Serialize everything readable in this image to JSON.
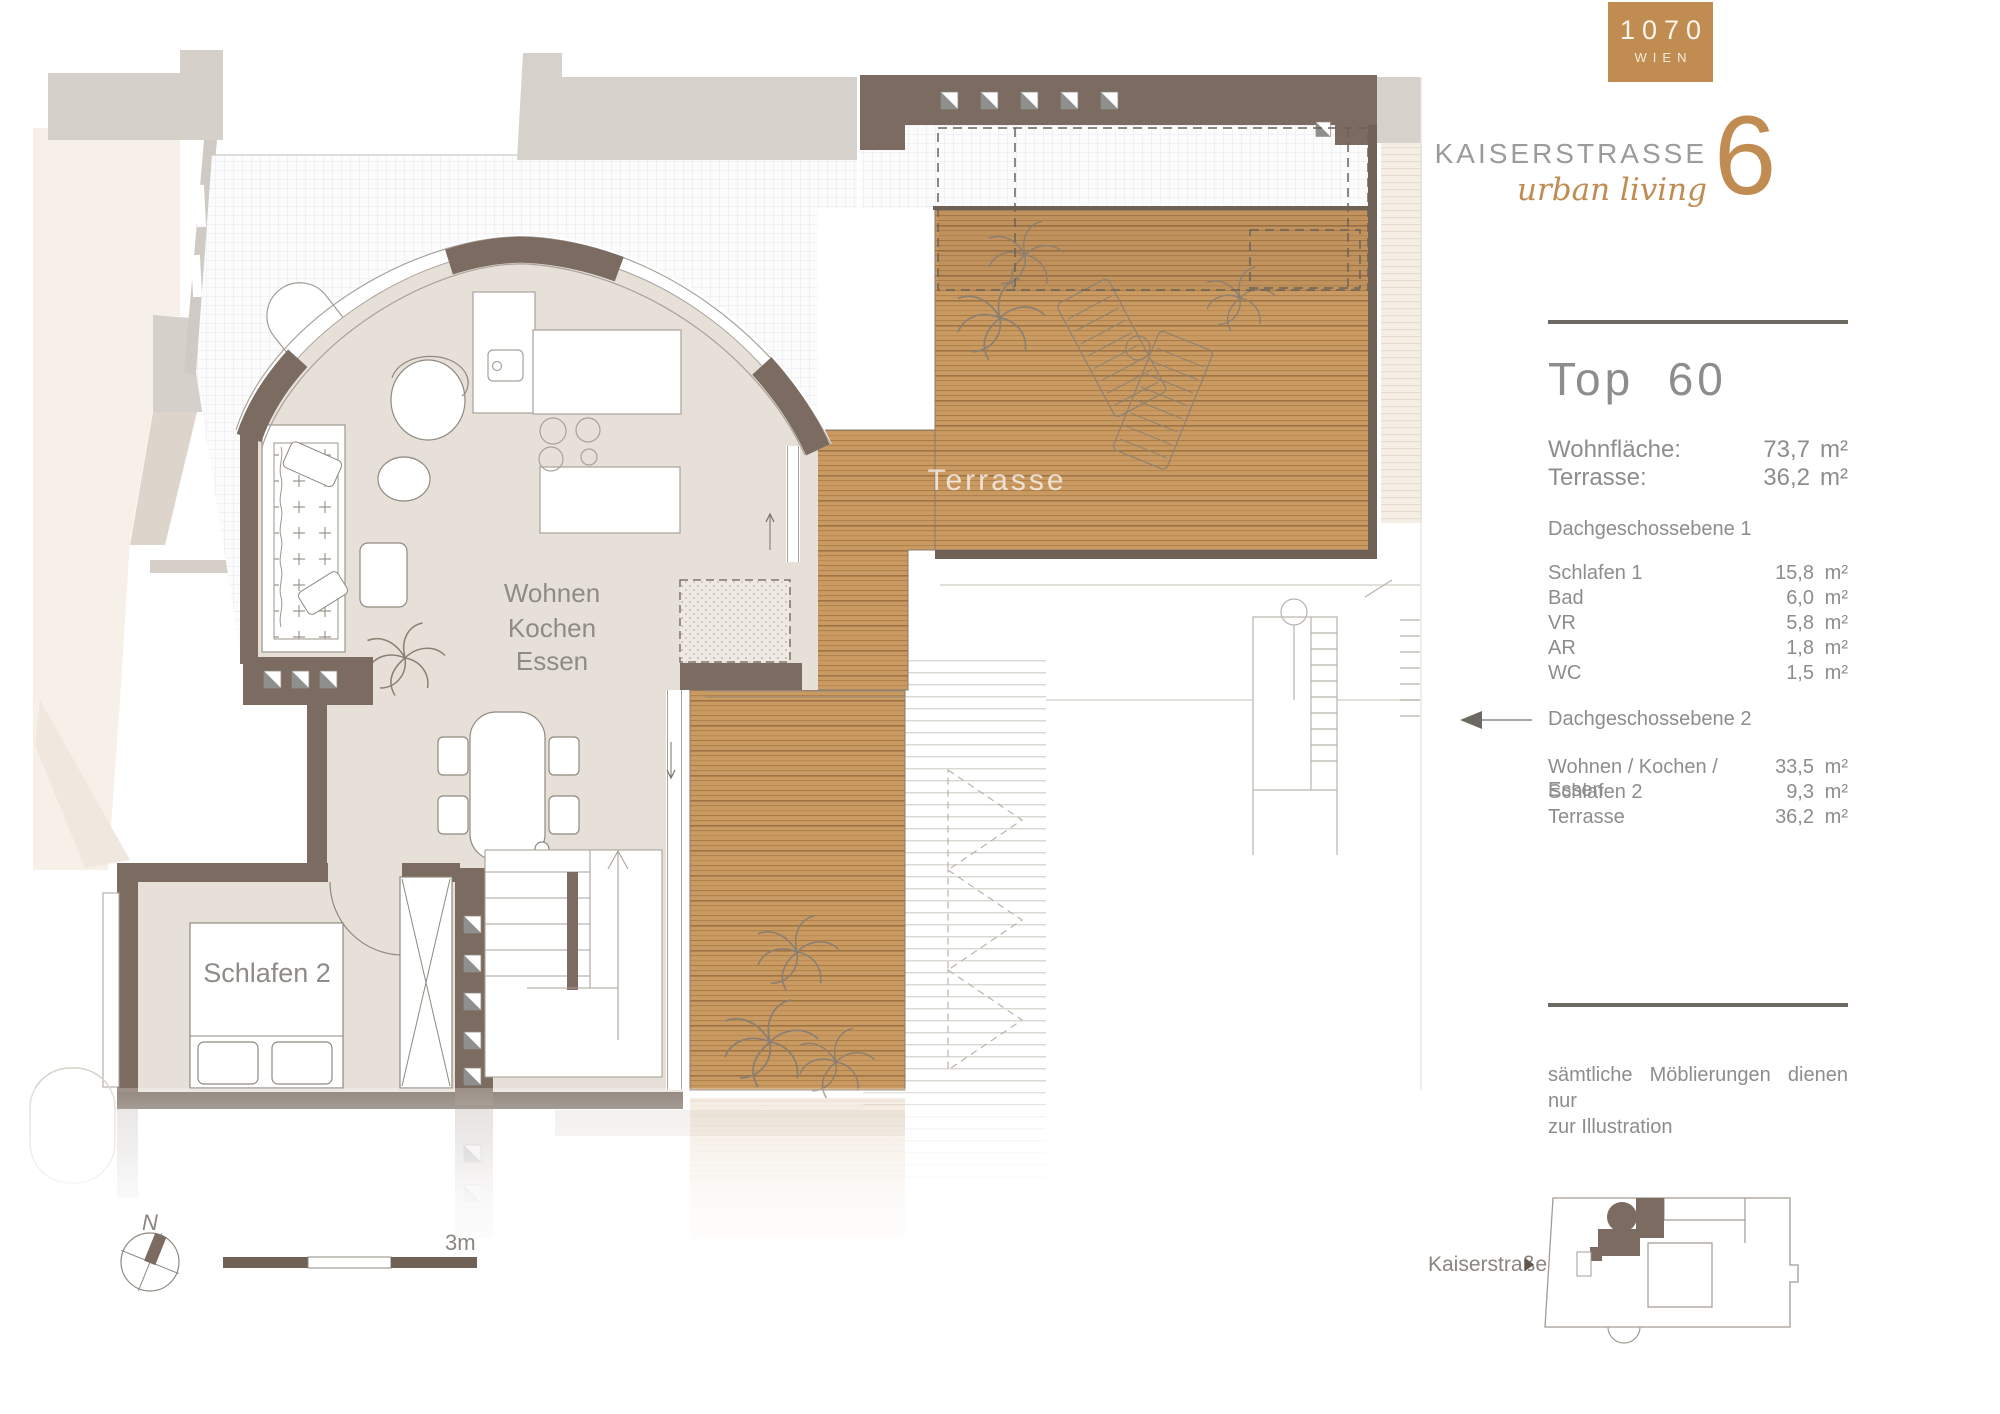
{
  "brand": {
    "district": "1070",
    "city": "WIEN",
    "name": "KAISERSTRASSE",
    "number": "6",
    "tagline": "urban living",
    "accent_color": "#c18c51"
  },
  "unit": {
    "title": "Top  60",
    "summary": [
      {
        "label": "Wohnfläche:",
        "value": "73,7",
        "unit": "m²"
      },
      {
        "label": "Terrasse:",
        "value": "36,2",
        "unit": "m²"
      }
    ],
    "level1": {
      "heading": "Dachgeschossebene 1",
      "rooms": [
        {
          "name": "Schlafen 1",
          "area": "15,8",
          "unit": "m²"
        },
        {
          "name": "Bad",
          "area": "6,0",
          "unit": "m²"
        },
        {
          "name": "VR",
          "area": "5,8",
          "unit": "m²"
        },
        {
          "name": "AR",
          "area": "1,8",
          "unit": "m²"
        },
        {
          "name": "WC",
          "area": "1,5",
          "unit": "m²"
        }
      ]
    },
    "level2": {
      "heading": "Dachgeschossebene 2",
      "rooms": [
        {
          "name": "Wohnen / Kochen / Essen",
          "area": "33,5",
          "unit": "m²"
        },
        {
          "name": "Schlafen 2",
          "area": "9,3",
          "unit": "m²"
        },
        {
          "name": "Terrasse",
          "area": "36,2",
          "unit": "m²"
        }
      ]
    },
    "note1": "sämtliche Möblierungen dienen nur",
    "note2": "zur Illustration"
  },
  "plan": {
    "labels": {
      "living": [
        "Wohnen",
        "Kochen",
        "Essen"
      ],
      "bedroom2": "Schlafen 2",
      "terrace": "Terrasse"
    },
    "compass": "N",
    "scale": "3m",
    "street": "Kaiserstraße",
    "wall_color": "#7b6b60",
    "wood_color": "#c99a61",
    "floor_color": "#e6e0d9",
    "text_color": "#8d8d8b"
  }
}
